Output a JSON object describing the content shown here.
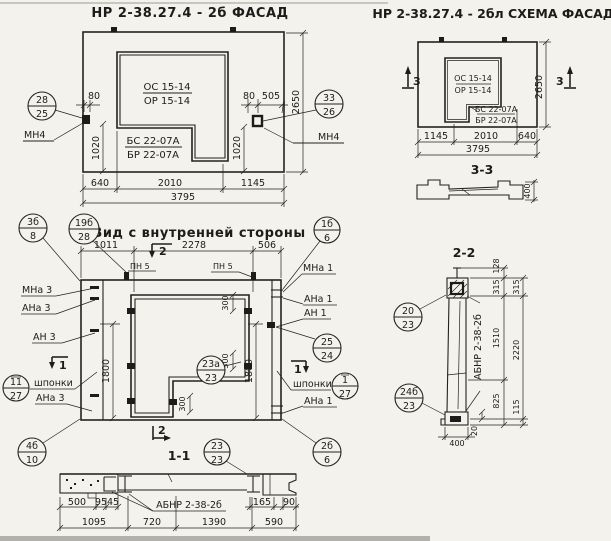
{
  "facade": {
    "title": "НР 2-38.27.4 - 2б  ФАСАД",
    "window_mark_line1": "ОС 15-14",
    "window_mark_line2": "ОР 15-14",
    "sill_mark_line1": "БС 22-07А",
    "sill_mark_line2": "БР 22-07А",
    "callout_left_top": "28",
    "callout_left_bottom": "25",
    "callout_right_top": "33",
    "callout_right_bottom": "26",
    "anchor_left": "МН4",
    "anchor_right": "МН4",
    "dim_80_left": "80",
    "dim_80_right": "80",
    "dim_505": "505",
    "dim_height": "2650",
    "dim_1020_left": "1020",
    "dim_1020_right": "1020",
    "dim_640": "640",
    "dim_2010": "2010",
    "dim_1145": "1145",
    "dim_total": "3795"
  },
  "scheme": {
    "title": "НР 2-38.27.4 - 2бл СХЕМА ФАСАДА",
    "window_mark_line1": "ОС 15-14",
    "window_mark_line2": "ОР 15-14",
    "sill_mark_line1": "БС 22-07А",
    "sill_mark_line2": "БР 22-07А",
    "section_marker": "3",
    "dim_height": "2650",
    "dim_1145": "1145",
    "dim_2010": "2010",
    "dim_640": "640",
    "dim_total": "3795"
  },
  "section33": {
    "title": "3-3",
    "dim_depth": "400"
  },
  "inner_view": {
    "title": "Вид с внутренней стороны",
    "dim_1011": "1011",
    "dim_2278": "2278",
    "dim_506": "506",
    "dim_1800_left": "1800",
    "dim_1800_right": "1800",
    "dim_300_top": "300",
    "dim_300_mid": "300",
    "dim_300_bottom": "300",
    "label_pn5_left": "ПН 5",
    "label_pn5_right": "ПН 5",
    "label_mna1": "МНа 1",
    "label_ana1_top": "АНа 1",
    "label_an1": "АН 1",
    "label_ana1_bottom": "АНа 1",
    "label_mna3": "МНа 3",
    "label_ana3_top": "АНа 3",
    "label_an3": "АН 3",
    "label_ana3_bottom": "АНа 3",
    "label_keys_left": "шпонки",
    "label_keys_right": "шпонки",
    "callout_3b_top": "3б",
    "callout_3b_bottom": "8",
    "callout_19b_top": "19б",
    "callout_19b_bottom": "28",
    "callout_1b_top": "1б",
    "callout_1b_bottom": "6",
    "callout_25_top": "25",
    "callout_25_bottom": "24",
    "callout_23a_top": "23а",
    "callout_23a_bottom": "23",
    "callout_2b_top": "2б",
    "callout_2b_bottom": "6",
    "callout_4b_top": "4б",
    "callout_4b_bottom": "10",
    "callout_keys_left_top": "11",
    "callout_keys_left_bottom": "27",
    "callout_keys_right_top": "1",
    "callout_keys_right_bottom": "27",
    "marker_1": "1",
    "marker_2": "2"
  },
  "section11": {
    "title": "1-1",
    "callout_top": "23",
    "callout_bottom": "23",
    "label_abnr": "АБНР 2-38-2б",
    "dim_500": "500",
    "dim_95": "95",
    "dim_45": "45",
    "dim_165": "165",
    "dim_90": "90",
    "dim_1095": "1095",
    "dim_720": "720",
    "dim_1390": "1390",
    "dim_590": "590"
  },
  "section22": {
    "title": "2-2",
    "label_abnr": "АБНР 2-38-2б",
    "callout_20_top": "20",
    "callout_20_bottom": "23",
    "callout_24b_top": "24б",
    "callout_24b_bottom": "23",
    "dim_128": "128",
    "dim_315_a": "315",
    "dim_315_b": "315",
    "dim_1510": "1510",
    "dim_2220": "2220",
    "dim_825": "825",
    "dim_115": "115",
    "dim_20": "20",
    "dim_400": "400"
  }
}
